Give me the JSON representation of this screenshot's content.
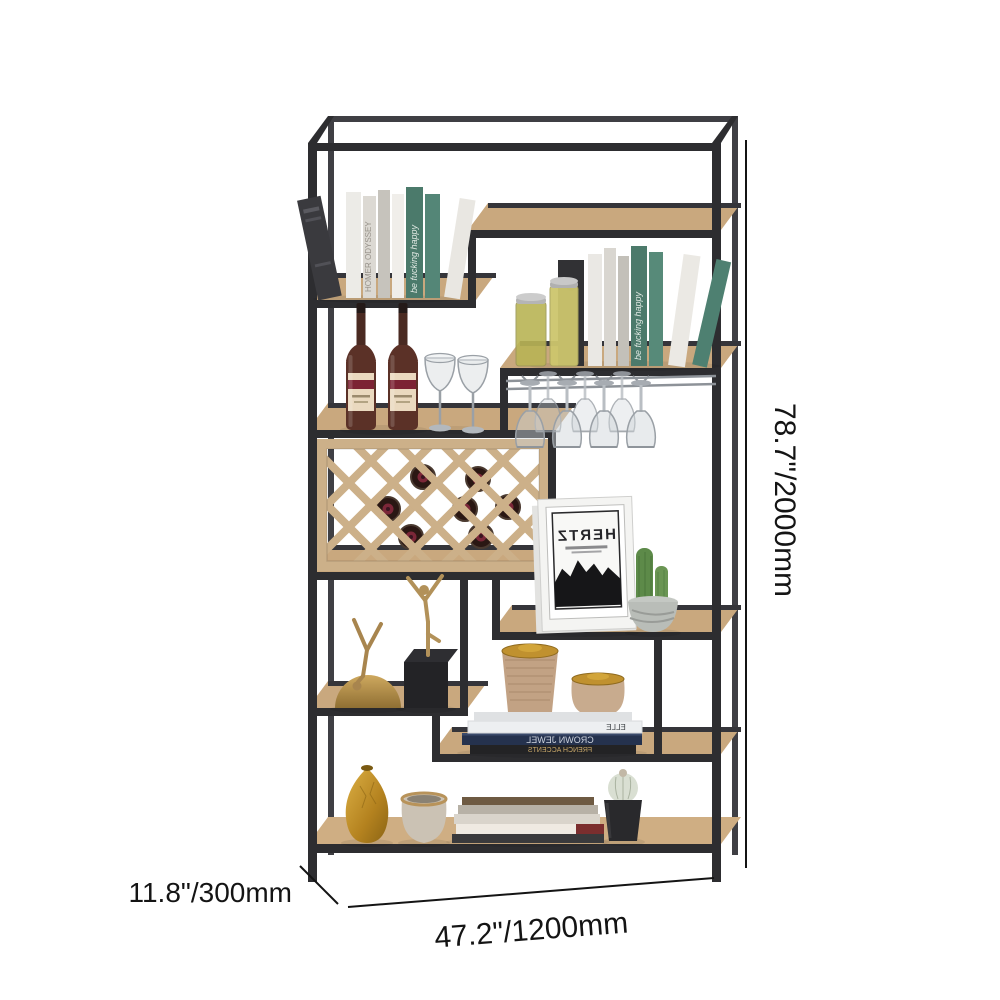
{
  "canvas": {
    "background": "#ffffff"
  },
  "product": {
    "name": "industrial etagere bookshelf with wine rack and glass holder",
    "frame_color": "#2d2d30",
    "wood_color": "#c9a87e",
    "lattice_color": "#ccb089",
    "accent_gold": "#c0912f"
  },
  "dimensions": {
    "height_label": "78.7\"/2000mm",
    "depth_label": "11.8\"/300mm",
    "width_label": "47.2\"/1200mm"
  },
  "decor": {
    "green_book_title": "be fucking happy",
    "white_book_title": "HOMER ODYSSEY",
    "frame_print_title": "HERTZ",
    "navy_book_title": "CROWN JEWEL",
    "white_album_title": "ELLE",
    "black_book_title": "FRENCH ACCENTS"
  }
}
